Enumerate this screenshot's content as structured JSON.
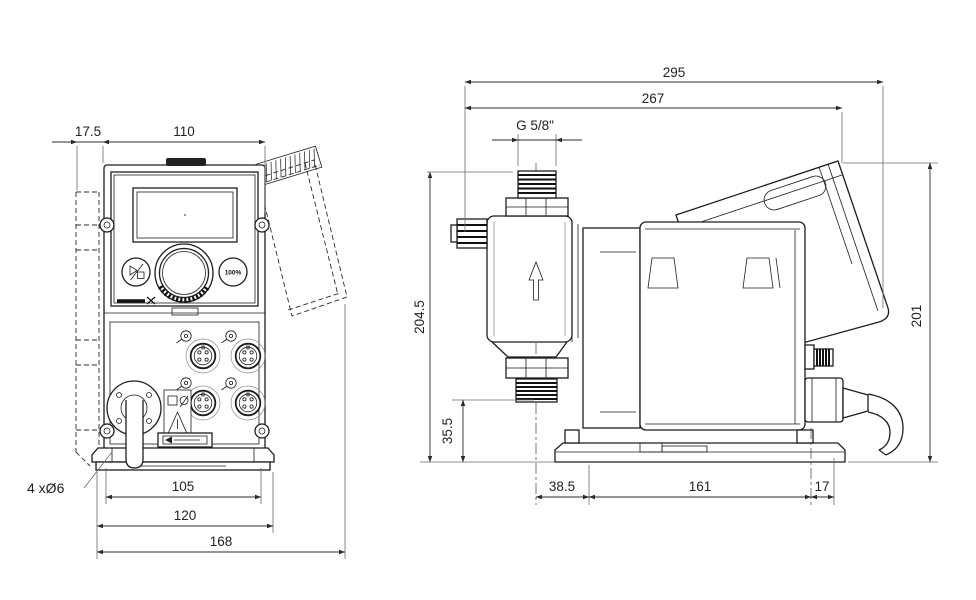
{
  "front": {
    "dims": {
      "offset": "17.5",
      "width": "110",
      "hole_span": "105",
      "plate_width": "120",
      "overall_width": "168"
    },
    "mount_note": "4 xØ6",
    "prime_button_label": "100%"
  },
  "side": {
    "dims": {
      "overall_length": "295",
      "length_to_panel": "267",
      "height": "204.5",
      "inlet_height": "35.5",
      "panel_height": "201",
      "head_offset": "38.5",
      "base_length": "161",
      "rear_offset": "17"
    },
    "connection_thread": "G 5/8\""
  },
  "colors": {
    "line": "#1d1d1d",
    "dimension": "#2b2b2b",
    "background": "#ffffff"
  }
}
